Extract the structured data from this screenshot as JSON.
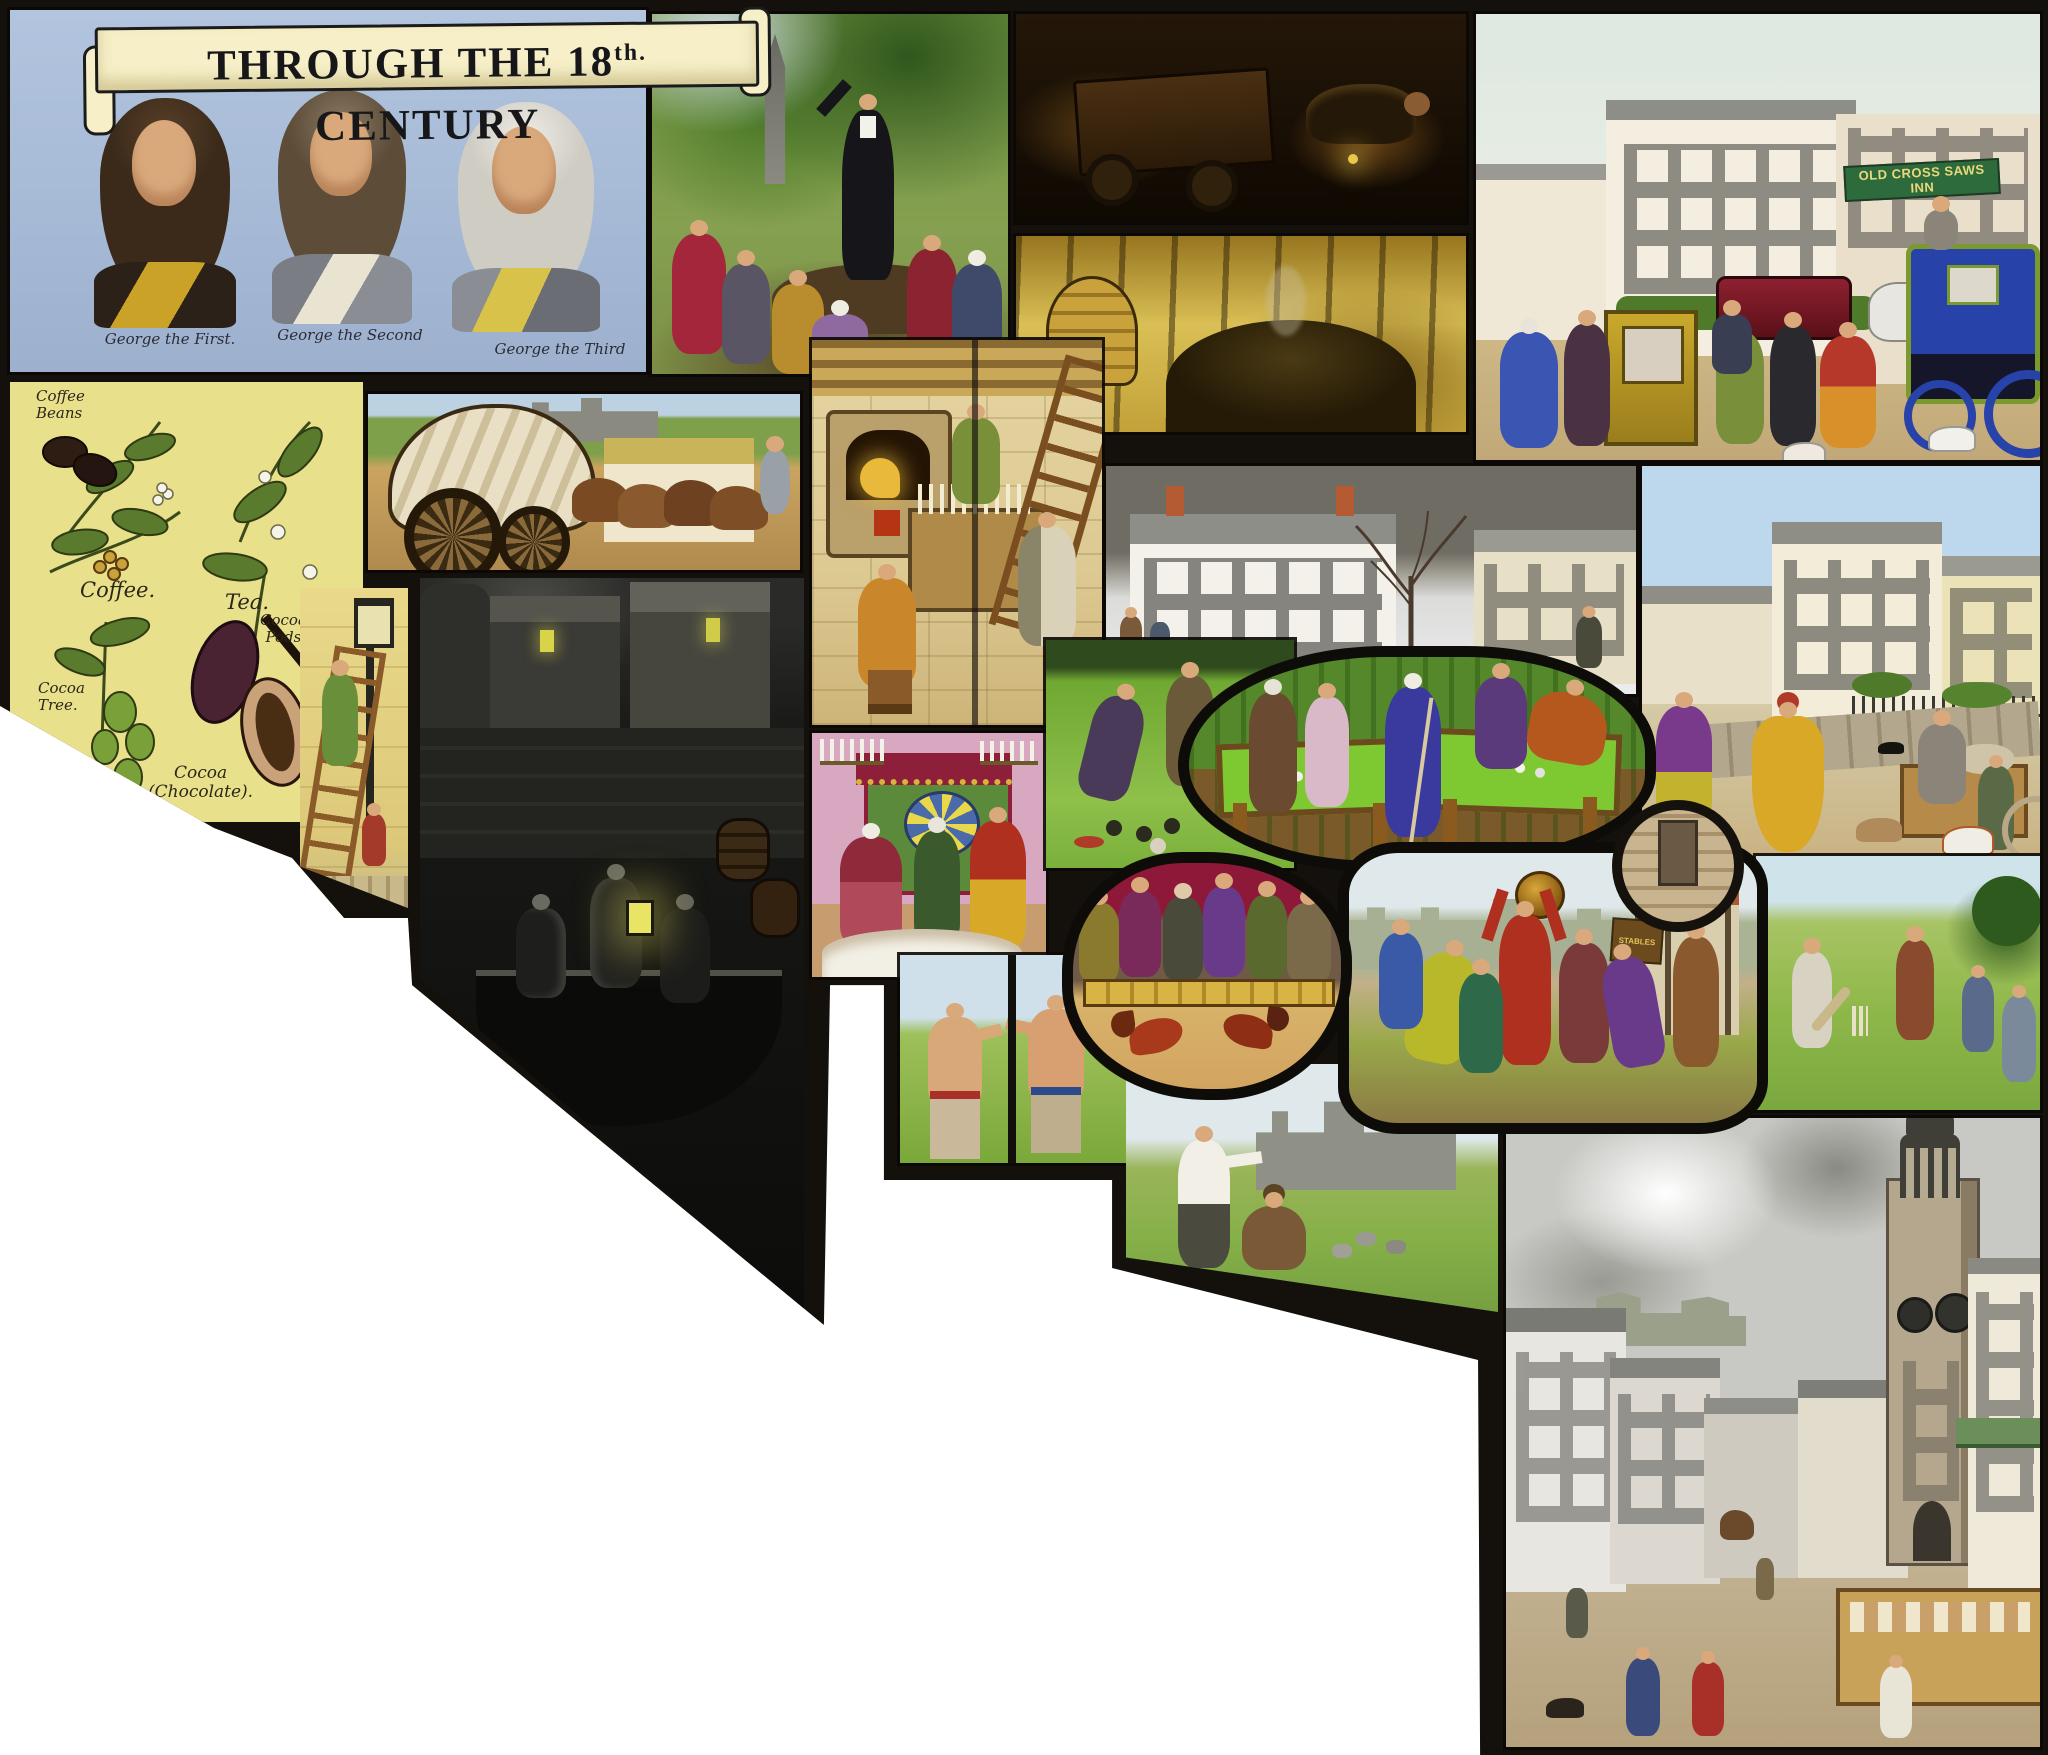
{
  "banner": {
    "prefix": "THROUGH THE 18",
    "superscript": "th.",
    "suffix": " CENTURY"
  },
  "kings": {
    "captions": [
      "George the First.",
      "George the Second",
      "George the Third"
    ]
  },
  "botanical": {
    "labels": {
      "coffee_beans": "Coffee\nBeans",
      "coffee": "Coffee.",
      "tea": "Tea.",
      "cocoa_pods": "Cocoa\nPods",
      "cocoa_tree": "Cocoa\nTree.",
      "cocoa_chocolate": "Cocoa\n(Chocolate)."
    }
  },
  "signs": {
    "inn": "OLD CROSS SAWS INN",
    "stables": "STABLES"
  },
  "colors": {
    "page_bg": "#ffffff",
    "frame_black": "#14110c",
    "kings_panel_blue": "#a9bdd9",
    "banner_cream": "#f6efc7",
    "banner_text": "#17171a",
    "botanical_yellow": "#e9e08c",
    "inn_sign_green": "#2e6b3c",
    "inn_sign_text": "#ead87c",
    "billiard_green": "#7ec832",
    "cockpit_crimson": "#8e1838",
    "night_black": "#131311",
    "charcoal_gold": "#d4b646"
  }
}
